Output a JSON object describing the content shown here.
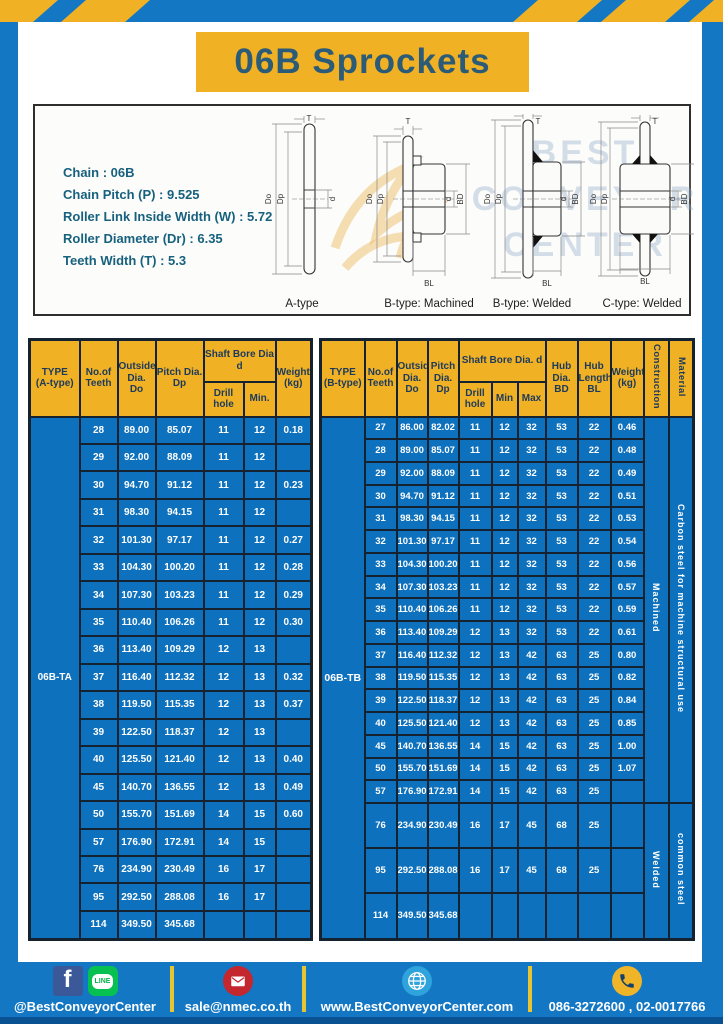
{
  "header": {
    "title": "06B Sprockets"
  },
  "specs": {
    "lines": [
      "Chain : 06B",
      "Chain Pitch (P) : 9.525",
      "Roller Link Inside Width (W) : 5.72",
      "Roller Diameter (Dr) : 6.35",
      "Teeth Width (T) : 5.3"
    ]
  },
  "watermark": {
    "line1": "BEST",
    "line2": "CONVEYOR",
    "line3": "CENTER"
  },
  "diagram_labels": {
    "T": "T",
    "Do": "Do",
    "Dp": "Dp",
    "d": "d",
    "BD": "BD",
    "BL": "BL"
  },
  "diagrams": [
    {
      "caption": "A-type"
    },
    {
      "caption": "B-type: Machined"
    },
    {
      "caption": "B-type: Welded"
    },
    {
      "caption": "C-type: Welded"
    }
  ],
  "tables": {
    "table_a": {
      "header": [
        [
          {
            "t": "TYPE\n(A-type)",
            "rs": 2
          },
          {
            "t": "No.of\nTeeth",
            "rs": 2
          },
          {
            "t": "Outside\nDia.\nDo",
            "rs": 2
          },
          {
            "t": "Pitch Dia.\nDp",
            "rs": 2
          },
          {
            "t": "Shaft Bore Dia d",
            "cs": 2
          },
          {
            "t": "Weight\n(kg)",
            "rs": 2
          }
        ],
        [
          {
            "t": "Drill hole"
          },
          {
            "t": "Min."
          }
        ]
      ],
      "body": [
        [
          {
            "t": "06B-TA",
            "rs": 19,
            "cl": "type"
          },
          "28",
          "89.00",
          "85.07",
          "11",
          "12",
          "0.18"
        ],
        [
          "29",
          "92.00",
          "88.09",
          "11",
          "12",
          ""
        ],
        [
          "30",
          "94.70",
          "91.12",
          "11",
          "12",
          "0.23"
        ],
        [
          "31",
          "98.30",
          "94.15",
          "11",
          "12",
          ""
        ],
        [
          "32",
          "101.30",
          "97.17",
          "11",
          "12",
          "0.27"
        ],
        [
          "33",
          "104.30",
          "100.20",
          "11",
          "12",
          "0.28"
        ],
        [
          "34",
          "107.30",
          "103.23",
          "11",
          "12",
          "0.29"
        ],
        [
          "35",
          "110.40",
          "106.26",
          "11",
          "12",
          "0.30"
        ],
        [
          "36",
          "113.40",
          "109.29",
          "12",
          "13",
          ""
        ],
        [
          "37",
          "116.40",
          "112.32",
          "12",
          "13",
          "0.32"
        ],
        [
          "38",
          "119.50",
          "115.35",
          "12",
          "13",
          "0.37"
        ],
        [
          "39",
          "122.50",
          "118.37",
          "12",
          "13",
          ""
        ],
        [
          "40",
          "125.50",
          "121.40",
          "12",
          "13",
          "0.40"
        ],
        [
          "45",
          "140.70",
          "136.55",
          "12",
          "13",
          "0.49"
        ],
        [
          "50",
          "155.70",
          "151.69",
          "14",
          "15",
          "0.60"
        ],
        [
          "57",
          "176.90",
          "172.91",
          "14",
          "15",
          ""
        ],
        [
          "76",
          "234.90",
          "230.49",
          "16",
          "17",
          ""
        ],
        [
          "95",
          "292.50",
          "288.08",
          "16",
          "17",
          ""
        ],
        [
          "114",
          "349.50",
          "345.68",
          "",
          "",
          ""
        ]
      ]
    },
    "table_b": {
      "header": [
        [
          {
            "t": "TYPE\n(B-type)",
            "rs": 2
          },
          {
            "t": "No.of\nTeeth",
            "rs": 2
          },
          {
            "t": "Outside\nDia.\nDo",
            "rs": 2
          },
          {
            "t": "Pitch\nDia.\nDp",
            "rs": 2
          },
          {
            "t": "Shaft Bore Dia. d",
            "cs": 3
          },
          {
            "t": "Hub\nDia.\nBD",
            "rs": 2
          },
          {
            "t": "Hub\nLength\nBL",
            "rs": 2
          },
          {
            "t": "Weight\n(kg)",
            "rs": 2
          },
          {
            "t": "Construction",
            "rs": 2,
            "cl": "vert"
          },
          {
            "t": "Material",
            "rs": 2,
            "cl": "vert"
          }
        ],
        [
          {
            "t": "Drill hole"
          },
          {
            "t": "Min"
          },
          {
            "t": "Max"
          }
        ]
      ],
      "body": [
        [
          {
            "t": "06B-TB",
            "rs": 20,
            "cl": "type"
          },
          "27",
          "86.00",
          "82.02",
          "11",
          "12",
          "32",
          "53",
          "22",
          "0.46",
          {
            "t": "Machined",
            "rs": 17,
            "cl": "vbody"
          },
          {
            "t": "Carbon steel for machine structural use",
            "rs": 17,
            "cl": "vbody"
          }
        ],
        [
          "28",
          "89.00",
          "85.07",
          "11",
          "12",
          "32",
          "53",
          "22",
          "0.48"
        ],
        [
          "29",
          "92.00",
          "88.09",
          "11",
          "12",
          "32",
          "53",
          "22",
          "0.49"
        ],
        [
          "30",
          "94.70",
          "91.12",
          "11",
          "12",
          "32",
          "53",
          "22",
          "0.51"
        ],
        [
          "31",
          "98.30",
          "94.15",
          "11",
          "12",
          "32",
          "53",
          "22",
          "0.53"
        ],
        [
          "32",
          "101.30",
          "97.17",
          "11",
          "12",
          "32",
          "53",
          "22",
          "0.54"
        ],
        [
          "33",
          "104.30",
          "100.20",
          "11",
          "12",
          "32",
          "53",
          "22",
          "0.56"
        ],
        [
          "34",
          "107.30",
          "103.23",
          "11",
          "12",
          "32",
          "53",
          "22",
          "0.57"
        ],
        [
          "35",
          "110.40",
          "106.26",
          "11",
          "12",
          "32",
          "53",
          "22",
          "0.59"
        ],
        [
          "36",
          "113.40",
          "109.29",
          "12",
          "13",
          "32",
          "53",
          "22",
          "0.61"
        ],
        [
          "37",
          "116.40",
          "112.32",
          "12",
          "13",
          "42",
          "63",
          "25",
          "0.80"
        ],
        [
          "38",
          "119.50",
          "115.35",
          "12",
          "13",
          "42",
          "63",
          "25",
          "0.82"
        ],
        [
          "39",
          "122.50",
          "118.37",
          "12",
          "13",
          "42",
          "63",
          "25",
          "0.84"
        ],
        [
          "40",
          "125.50",
          "121.40",
          "12",
          "13",
          "42",
          "63",
          "25",
          "0.85"
        ],
        [
          "45",
          "140.70",
          "136.55",
          "14",
          "15",
          "42",
          "63",
          "25",
          "1.00"
        ],
        [
          "50",
          "155.70",
          "151.69",
          "14",
          "15",
          "42",
          "63",
          "25",
          "1.07"
        ],
        [
          "57",
          "176.90",
          "172.91",
          "14",
          "15",
          "42",
          "63",
          "25",
          ""
        ],
        [
          "76",
          "234.90",
          "230.49",
          "16",
          "17",
          "45",
          "68",
          "25",
          "",
          {
            "t": "Welded",
            "rs": 3,
            "cl": "vbody"
          },
          {
            "t": "common steel",
            "rs": 3,
            "cl": "vbody"
          }
        ],
        [
          "95",
          "292.50",
          "288.08",
          "16",
          "17",
          "45",
          "68",
          "25",
          ""
        ],
        [
          "114",
          "349.50",
          "345.68",
          "",
          "",
          "",
          "",
          "",
          ""
        ]
      ]
    }
  },
  "footer": {
    "facebook_handle": "@BestConveyorCenter",
    "line_icon_text": "LINE",
    "email": "sale@nmec.co.th",
    "website": "www.BestConveyorCenter.com",
    "phone": "086-3272600 , 02-0017766"
  },
  "colors": {
    "frame_blue": "#1377c4",
    "banner_yellow": "#f0b125",
    "title_text": "#2b5b77",
    "spec_text": "#17617f",
    "table_header_yellow": "#f0b125",
    "table_body_blue": "#0d71bd",
    "table_border_navy": "#15222f",
    "footer_divider_yellow": "#e7c431",
    "facebook_blue": "#3b5998",
    "line_green": "#06c152",
    "mail_red": "#c4272e",
    "globe_blue": "#2fa3dc",
    "phone_yellow": "#f0b429",
    "bottom_strip_blue": "#0a5191"
  }
}
